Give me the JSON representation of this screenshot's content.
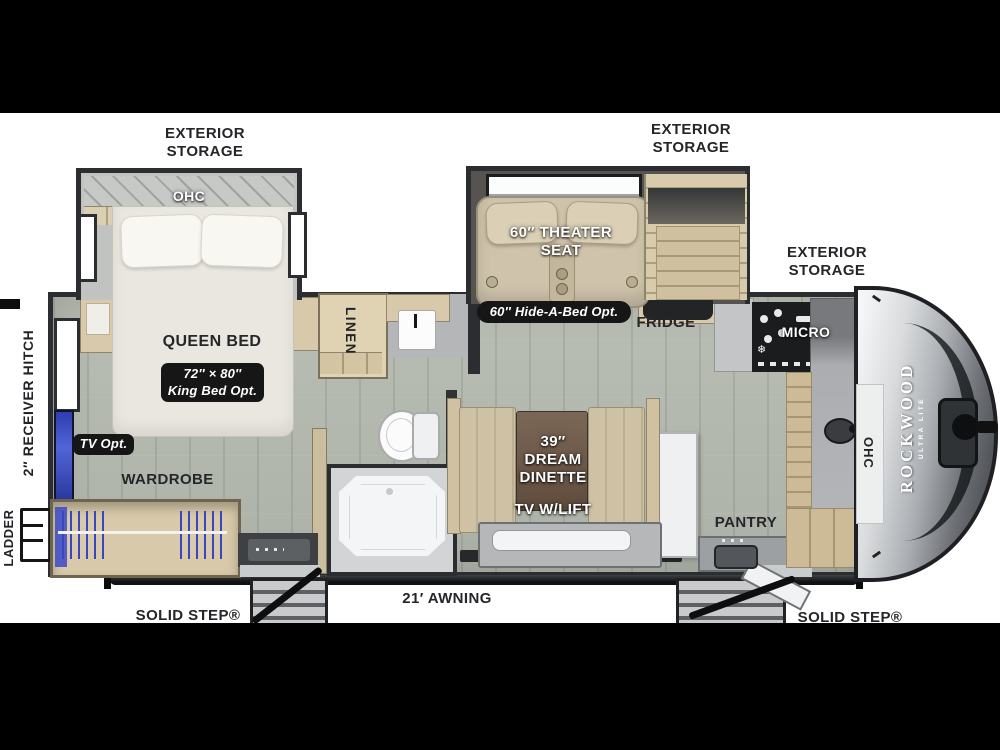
{
  "scene": {
    "description": "Top-view RV floor plan, Rockwood Ultra Lite travel trailer",
    "background": "#ffffff",
    "letterbox_bar_color": "#000000"
  },
  "palette": {
    "wall": "#2b2d31",
    "floor": "#b6bbb1",
    "cabinet_wood": "#d7c9a9",
    "seat_beige": "#cfc4ab",
    "tv_blue": "#3b49c9",
    "pill_bg": "#161616",
    "cap_silver": "#a6aaae",
    "label_dark": "#26262a",
    "label_white": "#ffffff"
  },
  "brand": {
    "name": "ROCKWOOD",
    "model": "ULTRA LITE"
  },
  "labels": {
    "exterior_storage": "EXTERIOR STORAGE",
    "ohc": "OHC",
    "queen_bed": {
      "l1": "QUEEN BED",
      "l2": "60″ × 80″"
    },
    "king_opt": {
      "l1": "72″ × 80″",
      "l2": "King Bed Opt."
    },
    "tv_opt": "TV Opt.",
    "wardrobe": "WARDROBE",
    "linen": "LINEN",
    "receiver_hitch": "2″ RECEIVER HITCH",
    "ladder": "LADDER",
    "theater": {
      "l1": "60″ THEATER",
      "l2": "SEAT"
    },
    "hide_a_bed": "60″ Hide-A-Bed Opt.",
    "fridge": "FRIDGE",
    "micro": "MICRO",
    "pantry": "PANTRY",
    "dinette": {
      "l1": "39″",
      "l2": "DREAM",
      "l3": "DINETTE"
    },
    "tv_lift": "TV W/LIFT",
    "solid_step": "SOLID STEP®",
    "entry": "ENTRY",
    "awning": "21′ AWNING"
  }
}
